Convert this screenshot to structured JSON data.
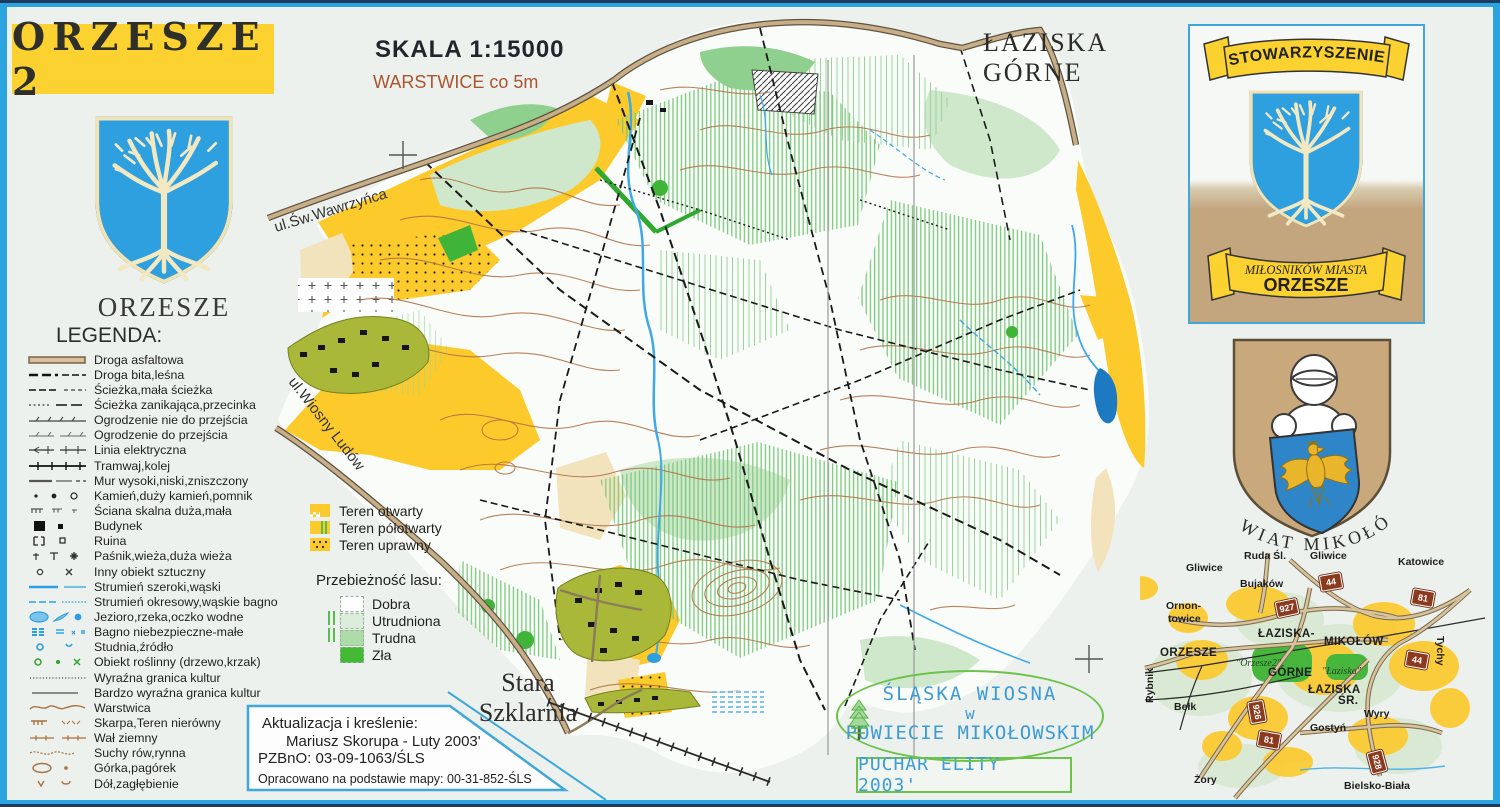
{
  "header": {
    "title": "ORZESZE 2",
    "scale_label": "SKALA 1:15000",
    "contour_label": "WARSTWICE co 5m"
  },
  "coat_of_arms": {
    "label": "ORZESZE"
  },
  "legend": {
    "title": "LEGENDA:",
    "items": [
      {
        "sym": "road-asphalt",
        "label": "Droga asfaltowa"
      },
      {
        "sym": "road-dirt",
        "label": "Droga bita,leśna"
      },
      {
        "sym": "path",
        "label": "Ścieżka,mała ścieżka"
      },
      {
        "sym": "path-vanishing",
        "label": "Ścieżka zanikająca,przecinka"
      },
      {
        "sym": "fence-impassable",
        "label": "Ogrodzenie nie do przejścia"
      },
      {
        "sym": "fence-passable",
        "label": "Ogrodzenie do przejścia"
      },
      {
        "sym": "power-line",
        "label": "Linia elektryczna"
      },
      {
        "sym": "railway",
        "label": "Tramwaj,kolej"
      },
      {
        "sym": "wall",
        "label": "Mur wysoki,niski,zniszczony"
      },
      {
        "sym": "stones",
        "label": "Kamień,duży kamień,pomnik"
      },
      {
        "sym": "rock-face",
        "label": "Ściana skalna duża,mała"
      },
      {
        "sym": "building",
        "label": "Budynek"
      },
      {
        "sym": "ruin",
        "label": "Ruina"
      },
      {
        "sym": "towers",
        "label": "Paśnik,wieża,duża wieża"
      },
      {
        "sym": "man-made",
        "label": "Inny obiekt sztuczny"
      },
      {
        "sym": "stream",
        "label": "Strumień szeroki,wąski"
      },
      {
        "sym": "stream-seasonal",
        "label": "Strumień okresowy,wąskie bagno"
      },
      {
        "sym": "waterbody",
        "label": "Jezioro,rzeka,oczko wodne"
      },
      {
        "sym": "marsh",
        "label": "Bagno niebezpieczne-małe"
      },
      {
        "sym": "well",
        "label": "Studnia,źródło"
      },
      {
        "sym": "vegetation",
        "label": "Obiekt roślinny (drzewo,krzak)"
      },
      {
        "sym": "veg-boundary",
        "label": "Wyraźna granica kultur"
      },
      {
        "sym": "veg-boundary-strong",
        "label": "Bardzo wyraźna granica kultur"
      },
      {
        "sym": "contour",
        "label": "Warstwica"
      },
      {
        "sym": "scarp",
        "label": "Skarpa,Teren nierówny"
      },
      {
        "sym": "earth-wall",
        "label": "Wał ziemny"
      },
      {
        "sym": "dry-ditch",
        "label": "Suchy rów,rynna"
      },
      {
        "sym": "knoll",
        "label": "Górka,pagórek"
      },
      {
        "sym": "pit",
        "label": "Dół,zagłębienie"
      }
    ]
  },
  "terrain_legend": {
    "items": [
      {
        "style": "open",
        "label": "Teren otwarty"
      },
      {
        "style": "semiopen",
        "label": "Teren półotwarty"
      },
      {
        "style": "cultivated",
        "label": "Teren uprawny"
      }
    ]
  },
  "runnability_legend": {
    "title": "Przebieżność lasu:",
    "items": [
      {
        "label": "Dobra",
        "color": "#FDFEFD",
        "stripes": false
      },
      {
        "label": "Utrudniona",
        "color": "#DCEEDB",
        "stripes": true
      },
      {
        "label": "Trudna",
        "color": "#AEDBAA",
        "stripes": true
      },
      {
        "label": "Zła",
        "color": "#44B935",
        "stripes": false
      }
    ]
  },
  "credits": {
    "line1": "Aktualizacja i kreślenie:",
    "line2": "Mariusz Skorupa - Luty 2003'",
    "line3": "PZBnO: 03-09-1063/ŚLS",
    "line4": "Opracowano na podstawie mapy: 00-31-852-ŚLS"
  },
  "map_labels": {
    "city_line1": "ŁAZISKA",
    "city_line2": "GÓRNE",
    "village_line1": "Stara",
    "village_line2": "Szklarnia",
    "street_1": "ul.Św.Wawrzyńca",
    "street_2": "ul.Wiosny Ludów"
  },
  "stamp": {
    "line1": "ŚLĄSKA WIOSNA",
    "line2": "w",
    "line3": "POWIECIE MIKOŁOWSKIM",
    "cup": "PUCHAR ELITY 2003'"
  },
  "association_badge": {
    "ribbon_top": "STOWARZYSZENIE",
    "ribbon_line1": "MIŁOSNIKÓW MIASTA",
    "ribbon_line2": "ORZESZE"
  },
  "powiat_badge": {
    "label": "POWIAT MIKOŁÓW"
  },
  "minimap": {
    "towns": [
      {
        "label": "Gliwice",
        "x": 46,
        "y": 14
      },
      {
        "label": "Ruda Śl.",
        "x": 104,
        "y": 2
      },
      {
        "label": "Gliwice",
        "x": 170,
        "y": 2
      },
      {
        "label": "Katowice",
        "x": 258,
        "y": 8
      },
      {
        "label": "Bujaków",
        "x": 100,
        "y": 30
      },
      {
        "label": "Ornon-",
        "x": 26,
        "y": 52
      },
      {
        "label": "towice",
        "x": 28,
        "y": 65
      },
      {
        "label": "ŁAZISKA-",
        "x": 118,
        "y": 80,
        "cls": "caps"
      },
      {
        "label": "MIKOŁÓW",
        "x": 184,
        "y": 88,
        "cls": "caps"
      },
      {
        "label": "ORZESZE",
        "x": 20,
        "y": 99,
        "cls": "caps"
      },
      {
        "label": "\"Orzesze2\"",
        "x": 96,
        "y": 110,
        "cls": "it"
      },
      {
        "label": "GÓRNE",
        "x": 128,
        "y": 119,
        "cls": "caps"
      },
      {
        "label": "\"Łaziska\"",
        "x": 182,
        "y": 118,
        "cls": "it"
      },
      {
        "label": "ŁAZISKA",
        "x": 168,
        "y": 136,
        "cls": "caps"
      },
      {
        "label": "ŚR.",
        "x": 198,
        "y": 147,
        "cls": "caps"
      },
      {
        "label": "Rybnik",
        "x": 4,
        "y": 155,
        "rot": -90
      },
      {
        "label": "Tychy",
        "x": 306,
        "y": 88,
        "rot": 90
      },
      {
        "label": "Bełk",
        "x": 34,
        "y": 153
      },
      {
        "label": "Wyry",
        "x": 224,
        "y": 160
      },
      {
        "label": "Gostyń",
        "x": 170,
        "y": 174
      },
      {
        "label": "Żory",
        "x": 54,
        "y": 226
      },
      {
        "label": "Bielsko-Biała",
        "x": 204,
        "y": 232
      }
    ],
    "road_badges": [
      {
        "num": "44",
        "x": 180,
        "y": 26,
        "rot": -10
      },
      {
        "num": "81",
        "x": 272,
        "y": 42,
        "rot": 10
      },
      {
        "num": "927",
        "x": 136,
        "y": 52,
        "rot": -12
      },
      {
        "num": "44",
        "x": 266,
        "y": 104,
        "rot": 10
      },
      {
        "num": "926",
        "x": 106,
        "y": 156,
        "rot": 80
      },
      {
        "num": "81",
        "x": 118,
        "y": 184,
        "rot": 10
      },
      {
        "num": "928",
        "x": 226,
        "y": 206,
        "rot": 75
      }
    ]
  },
  "colors": {
    "frame_blue": "#2AA3DF",
    "banner_yellow": "#FBD230",
    "open_yellow": "#FDCA2C",
    "forest_green": "#44B935",
    "water_blue": "#2D9FE0",
    "contour_brown": "#A9713F",
    "shield_blue": "#2E9FDF",
    "crest_tan": "#C9A97C"
  }
}
